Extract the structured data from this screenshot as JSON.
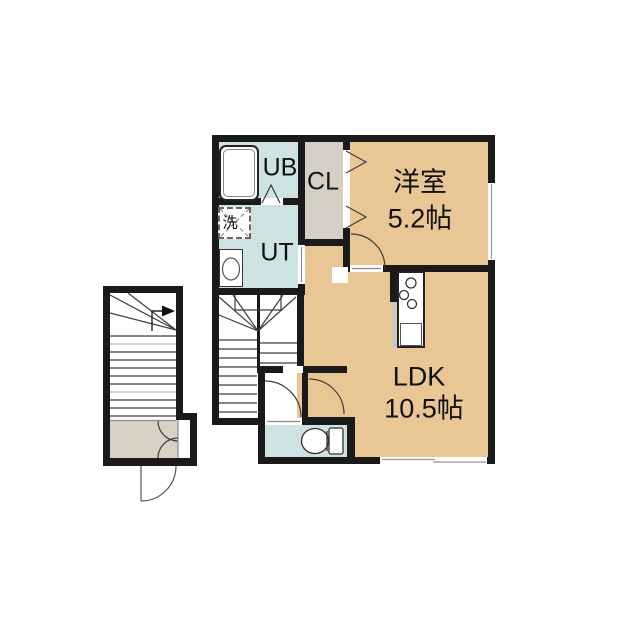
{
  "plan": {
    "rooms": {
      "ub": {
        "label": "UB"
      },
      "cl": {
        "label": "CL"
      },
      "ut": {
        "label": "UT"
      },
      "washer": {
        "label": "洗"
      },
      "western": {
        "label": "洋室",
        "size": "5.2帖"
      },
      "ldk": {
        "label": "LDK",
        "size": "10.5帖"
      }
    },
    "colors": {
      "room_tan": "#e9c795",
      "wet_blue": "#cfe2e2",
      "closet_gray": "#d4d0c5",
      "wall_black": "#1a1a1a"
    },
    "icons": [
      "bathtub-icon",
      "washing-machine-icon",
      "vanity-icon",
      "toilet-icon",
      "stove-burners-icon",
      "kitchen-sink-icon",
      "stair-direction-arrow-icon",
      "door-swing-arc",
      "bifold-door-icon",
      "window-symbol"
    ]
  }
}
